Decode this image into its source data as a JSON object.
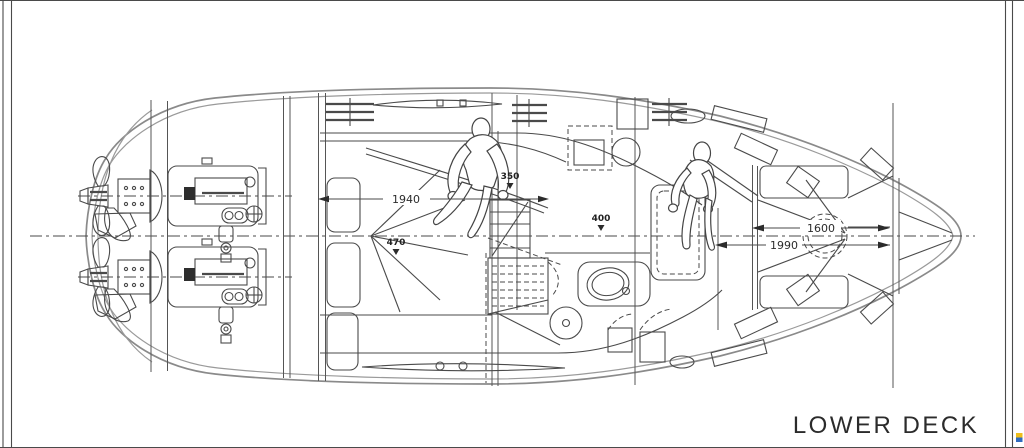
{
  "drawing": {
    "title": "LOWER DECK",
    "annotations": {
      "dim_1940": "1940",
      "dim_350": "350",
      "dim_400": "400",
      "dim_470": "470",
      "dim_1990": "1990",
      "dim_1600": "1600"
    },
    "colors": {
      "line": "#4a4a4a",
      "hull": "#8a8a8a",
      "background": "#ffffff",
      "logo_top": "#eebd1b",
      "logo_bottom": "#2f6bbf"
    }
  }
}
